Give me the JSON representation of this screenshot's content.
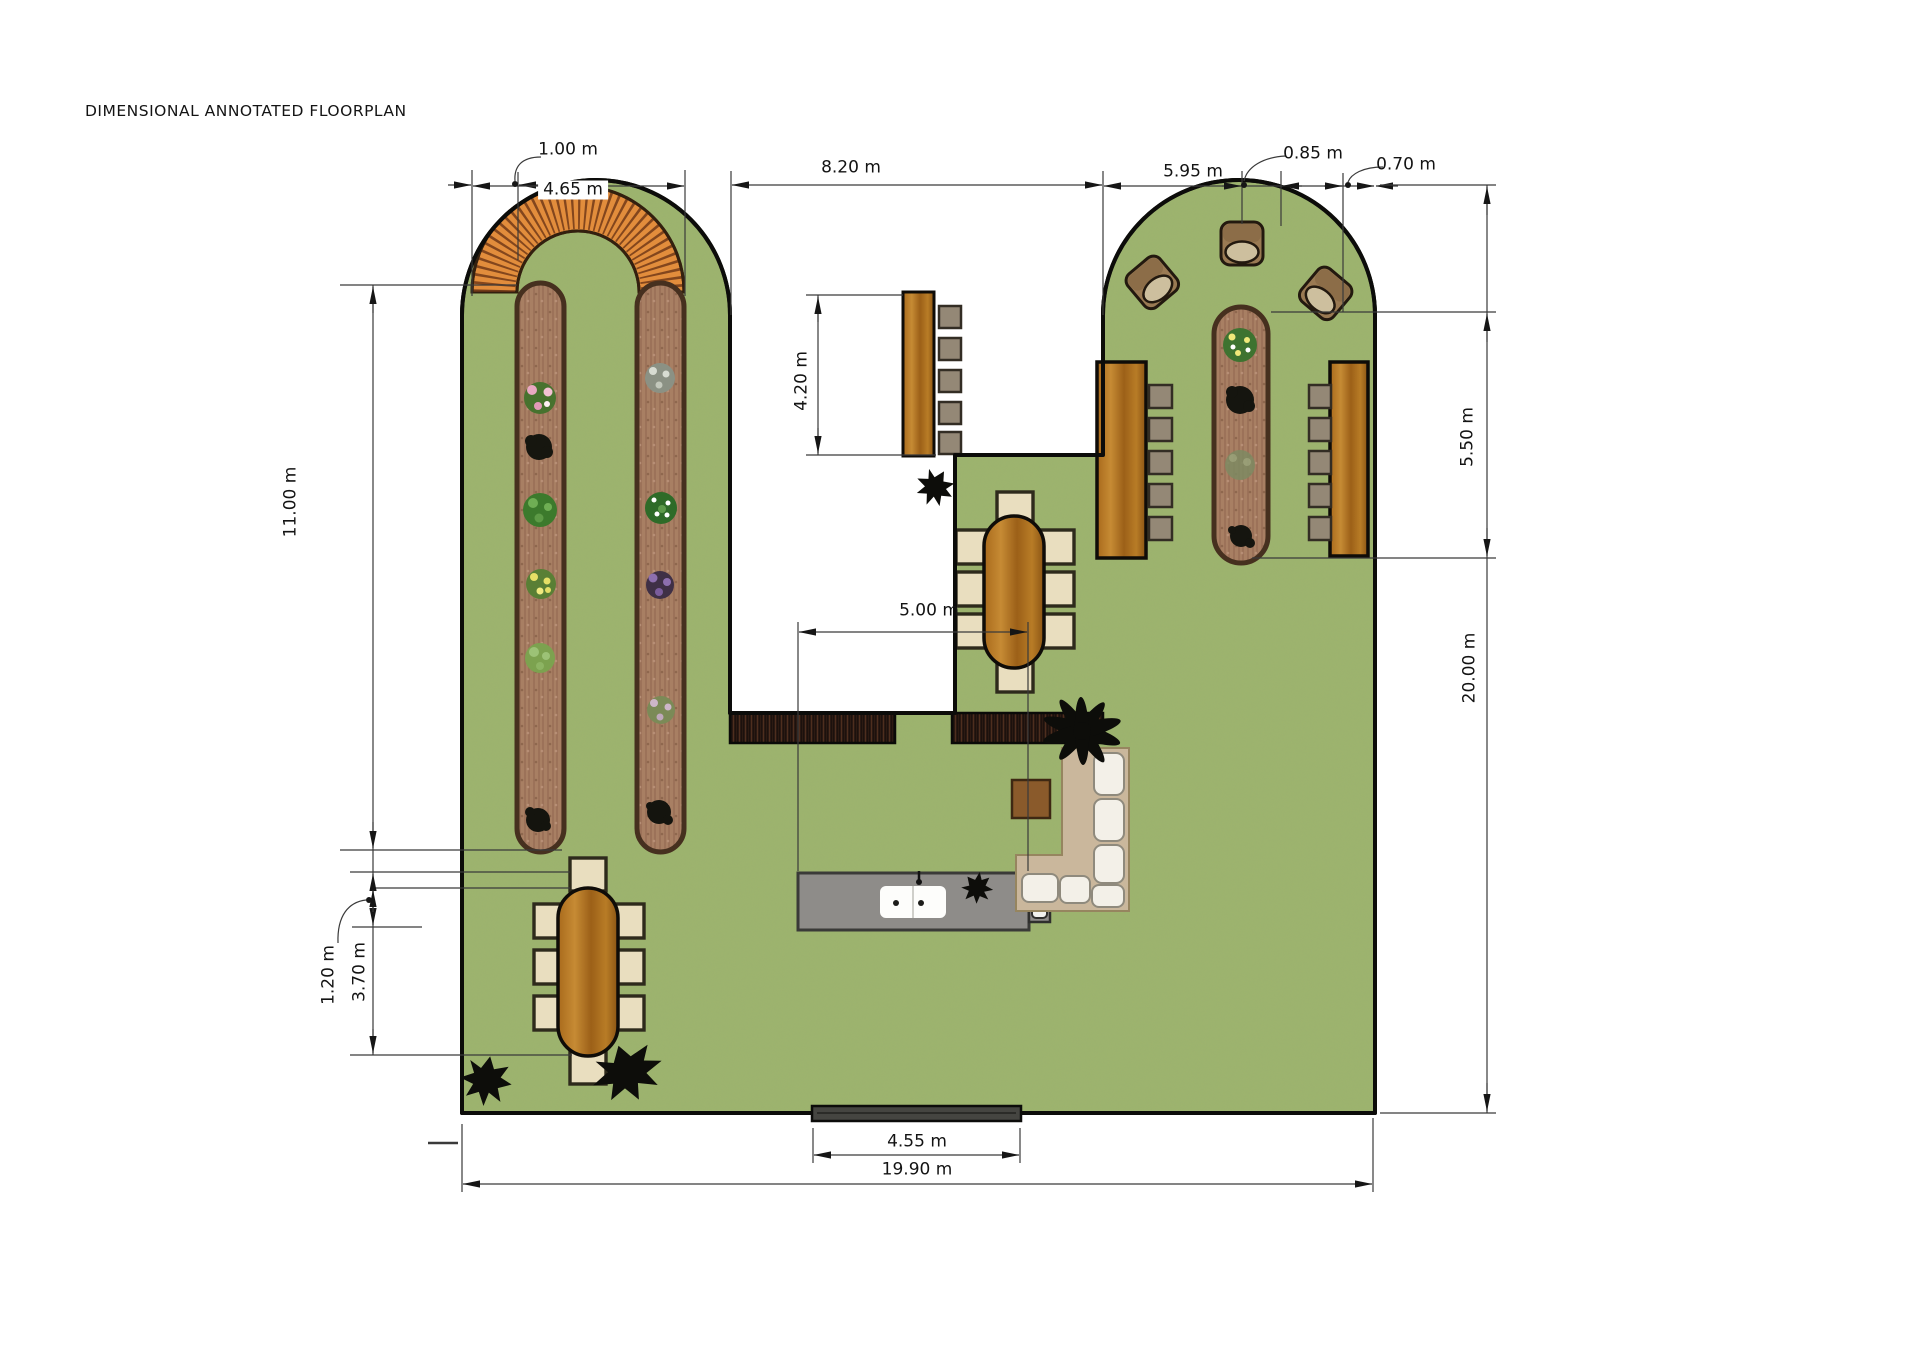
{
  "page": {
    "title": "DIMENSIONAL ANNOTATED FLOORPLAN"
  },
  "annotations": {
    "arc_band_width": "1.00 m",
    "arc_diameter": "4.65 m",
    "courtyard_width": "8.20 m",
    "right_lobe_width": "5.95 m",
    "planter_width": "0.85 m",
    "edge_gap": "0.70 m",
    "right_bed_length": "5.50 m",
    "site_height": "20.00 m",
    "left_bed_length": "11.00 m",
    "bench_length": "4.20 m",
    "island_length": "5.00 m",
    "table_offset": "1.20 m",
    "table_zone_length": "3.70 m",
    "step_width": "4.55 m",
    "site_width": "19.90 m"
  },
  "colors": {
    "grass": "#9db46c",
    "soil": "#a87f63",
    "wood": "#b4751f",
    "brick_arc": "#e28d3c",
    "island": "#8e8c89",
    "deck": "#1a100c",
    "lounge_mat": "#cab79c",
    "cushion": "#f3f0e8",
    "silhouette": "#0d0d0a",
    "dimension": "#3a3a3a"
  }
}
